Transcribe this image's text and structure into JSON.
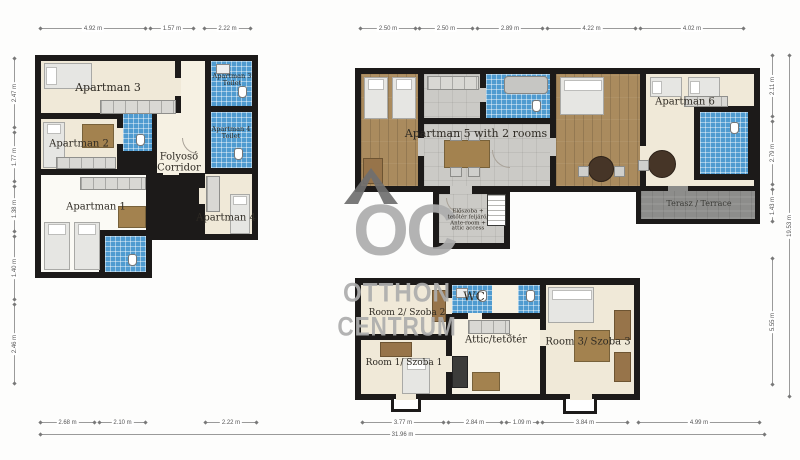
{
  "colors": {
    "wall": "#1c1a19",
    "beige": "#f0e9d8",
    "light": "#f6f1e3",
    "wood": "#aa8b5e",
    "tile_blue": "#4f9bd0",
    "tile_gray": "#cbcac6",
    "terrace": "#8d8d8b",
    "watermark": "#acacac"
  },
  "watermark": {
    "logo": "OC",
    "line1": "OTTHON",
    "line2": "CENTRUM"
  },
  "rooms": {
    "ap3": "Apartman 3",
    "t3a": "Apartman 3",
    "t3b": "Toilet",
    "t4a": "Apartman 4",
    "t4b": "Toilet",
    "ap2": "Apartman 2",
    "corr1": "Folyosó",
    "corr2": "Corridor",
    "ap1": "Apartman 1",
    "ap4": "Apartman 4",
    "ap5": "Apartman 5 with 2 rooms",
    "ap6": "Apartman 6",
    "terrace": "Terasz / Terrace",
    "ante1": "Előszoba +",
    "ante2": "tetőtér feljáró/",
    "ante3": "Ante-room +",
    "ante4": "attic access",
    "wc": "WC",
    "room2": "Room 2/ Szoba 2",
    "room1": "Room 1/ Szoba 1",
    "room3": "Room 3/ Szoba 3",
    "attic": "Attic/tetőtér"
  },
  "dims": {
    "left_top": [
      "4.92 m",
      "1.57 m",
      "2.22 m"
    ],
    "right_top": [
      "2.50 m",
      "2.50 m",
      "2.89 m",
      "4.22 m",
      "4.02 m"
    ],
    "left_bottom": [
      "2.68 m",
      "2.10 m",
      "2.22 m"
    ],
    "right_bottom": [
      "3.77 m",
      "2.84 m",
      "1.09 m",
      "3.84 m",
      "4.99 m"
    ],
    "left_side": [
      "2.47 m",
      "1.77 m",
      "1.38 m",
      "1.40 m",
      "2.46 m"
    ],
    "right_side": [
      "2.11 m",
      "2.79 m",
      "1.43 m",
      "5.55 m"
    ],
    "right_side_total": "19.53 m",
    "bottom_total": "31.96 m"
  }
}
